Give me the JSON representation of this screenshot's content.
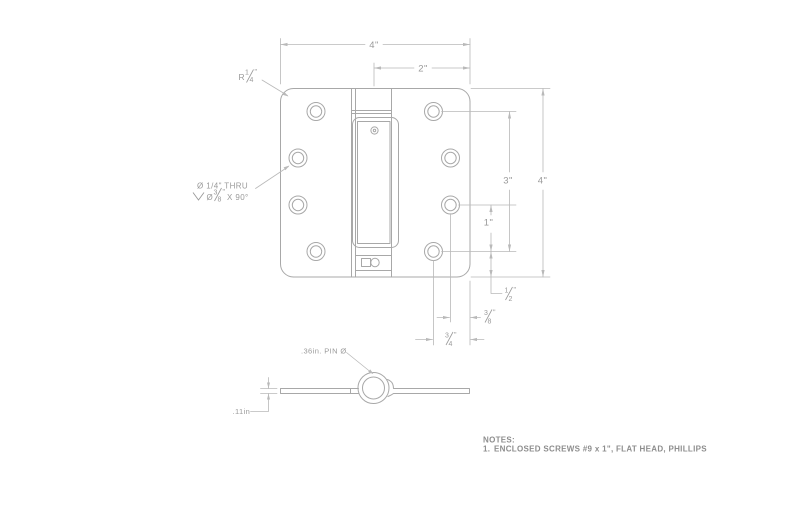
{
  "colors": {
    "background": "#ffffff",
    "part_line": "#a8a8a8",
    "dim_line": "#b9b9b9",
    "dim_text": "#9a9a9a",
    "notes_text": "#8d8d8d"
  },
  "top_view": {
    "width_dim": "4\"",
    "half_width_dim": "2\"",
    "height_dim": "4\"",
    "hole_span_dim": "3\"",
    "hole_pitch_dim": "1\"",
    "corner_radius": {
      "prefix": "R",
      "num": "1",
      "den": "4",
      "unit": "\""
    },
    "hole_callout": {
      "line1": "Ø 1/4\" THRU",
      "line2_prefix": "Ø",
      "line2_frac": {
        "num": "3",
        "den": "8",
        "unit": "\""
      },
      "line2_suffix": "X 90°"
    },
    "edge_dist_half": {
      "num": "1",
      "den": "2",
      "unit": "\""
    },
    "edge_dist_3_8": {
      "num": "3",
      "den": "8",
      "unit": "\""
    },
    "edge_dist_3_4": {
      "num": "3",
      "den": "4",
      "unit": "\""
    }
  },
  "side_view": {
    "pin_dia_label": ".36in. PIN Ø",
    "thickness_label": ".11in"
  },
  "notes": {
    "title": "NOTES:",
    "item_number": "1.",
    "item_text": "ENCLOSED SCREWS #9 x 1\", FLAT HEAD, PHILLIPS"
  }
}
